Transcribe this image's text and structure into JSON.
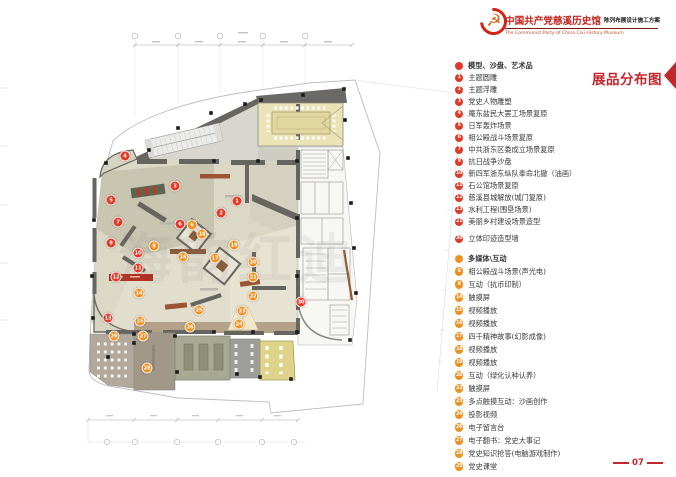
{
  "header": {
    "title_cn": "中国共产党慈溪历史馆",
    "title_en": "The Communist Party of China Cixi  History Museum",
    "subtitle": "陈列布展设计施工方案",
    "logo": "hammer-sickle-emblem"
  },
  "section_title": "展品分布图",
  "page_number": "07",
  "watermark": "海韵红迪",
  "colors": {
    "red": "#e23a28",
    "orange": "#ef9122",
    "accent": "#c2272c"
  },
  "legend": {
    "sections": [
      {
        "dot_color": "#e23a28",
        "title": "模型、沙盘、艺术品",
        "items": [
          {
            "n": "1",
            "label": "主题圆雕"
          },
          {
            "n": "2",
            "label": "主题浮雕"
          },
          {
            "n": "3",
            "label": "党史人物雕塑"
          },
          {
            "n": "4",
            "label": "庵东盐民大罢工场景复原"
          },
          {
            "n": "5",
            "label": "日军轰炸场景"
          },
          {
            "n": "6",
            "label": "相公殿战斗场景复原"
          },
          {
            "n": "7",
            "label": "中共浙东区委成立场景复原"
          },
          {
            "n": "9",
            "label": "抗日战争沙盘"
          },
          {
            "n": "10",
            "label": "新四军浙东纵队奉命北撤（油画）"
          },
          {
            "n": "11",
            "label": "石公馆场景复原"
          },
          {
            "n": "12",
            "label": "慈溪县城解放(城门复原)"
          },
          {
            "n": "13",
            "label": "水利工程(围垦场景)"
          },
          {
            "n": "21",
            "label": "美丽乡村建设场景造型"
          },
          {
            "n": "30",
            "label": "立体印迹造型墙"
          }
        ]
      },
      {
        "dot_color": "#ef9122",
        "title": "多媒体\\互动",
        "items": [
          {
            "n": "6",
            "label": "相公殿战斗场景(声光电)"
          },
          {
            "n": "8",
            "label": "互动（抗币印制）"
          },
          {
            "n": "14",
            "label": "触摸屏"
          },
          {
            "n": "15",
            "label": "视频播放"
          },
          {
            "n": "16",
            "label": "视频播放"
          },
          {
            "n": "17",
            "label": "四千精神故事(幻影成像)"
          },
          {
            "n": "18",
            "label": "视频播放"
          },
          {
            "n": "19",
            "label": "视频播放"
          },
          {
            "n": "20",
            "label": "互动（绿化认种认养）"
          },
          {
            "n": "22",
            "label": "触摸屏"
          },
          {
            "n": "23",
            "label": "多点触摸互动：沙画创作"
          },
          {
            "n": "24",
            "label": "投影视频"
          },
          {
            "n": "26",
            "label": "电子留言台"
          },
          {
            "n": "27",
            "label": "电子翻书：党史大事记"
          },
          {
            "n": "28",
            "label": "党史知识抢答(电脑游戏制作)"
          },
          {
            "n": "29",
            "label": "党史课堂"
          }
        ]
      }
    ]
  },
  "plan": {
    "markers": [
      {
        "n": "1",
        "color": "red",
        "x": 237,
        "y": 201
      },
      {
        "n": "2",
        "color": "red",
        "x": 221,
        "y": 213
      },
      {
        "n": "3",
        "color": "red",
        "x": 175,
        "y": 186
      },
      {
        "n": "4",
        "color": "red",
        "x": 125,
        "y": 156
      },
      {
        "n": "5",
        "color": "red",
        "x": 111,
        "y": 200
      },
      {
        "n": "6",
        "color": "red",
        "x": 180,
        "y": 224
      },
      {
        "n": "7",
        "color": "red",
        "x": 118,
        "y": 222
      },
      {
        "n": "9",
        "color": "red",
        "x": 111,
        "y": 243
      },
      {
        "n": "10",
        "color": "red",
        "x": 138,
        "y": 253
      },
      {
        "n": "11",
        "color": "red",
        "x": 138,
        "y": 268
      },
      {
        "n": "12",
        "color": "red",
        "x": 116,
        "y": 277
      },
      {
        "n": "13",
        "color": "red",
        "x": 108,
        "y": 318
      },
      {
        "n": "30",
        "color": "red",
        "x": 301,
        "y": 302
      },
      {
        "n": "6",
        "color": "orange",
        "x": 192,
        "y": 225
      },
      {
        "n": "8",
        "color": "orange",
        "x": 154,
        "y": 246
      },
      {
        "n": "14",
        "color": "orange",
        "x": 139,
        "y": 293
      },
      {
        "n": "15",
        "color": "orange",
        "x": 140,
        "y": 321
      },
      {
        "n": "16",
        "color": "orange",
        "x": 183,
        "y": 257
      },
      {
        "n": "17",
        "color": "orange",
        "x": 215,
        "y": 258
      },
      {
        "n": "18",
        "color": "orange",
        "x": 202,
        "y": 234
      },
      {
        "n": "19",
        "color": "orange",
        "x": 234,
        "y": 245
      },
      {
        "n": "20",
        "color": "orange",
        "x": 253,
        "y": 262
      },
      {
        "n": "21",
        "color": "orange",
        "x": 253,
        "y": 277
      },
      {
        "n": "22",
        "color": "orange",
        "x": 253,
        "y": 296
      },
      {
        "n": "23",
        "color": "orange",
        "x": 242,
        "y": 311
      },
      {
        "n": "24",
        "color": "orange",
        "x": 239,
        "y": 324
      },
      {
        "n": "25",
        "color": "orange",
        "x": 199,
        "y": 310
      },
      {
        "n": "26",
        "color": "orange",
        "x": 190,
        "y": 327
      },
      {
        "n": "27",
        "color": "orange",
        "x": 143,
        "y": 336
      },
      {
        "n": "28",
        "color": "orange",
        "x": 147,
        "y": 368
      },
      {
        "n": "29",
        "color": "orange",
        "x": 114,
        "y": 336
      }
    ]
  }
}
